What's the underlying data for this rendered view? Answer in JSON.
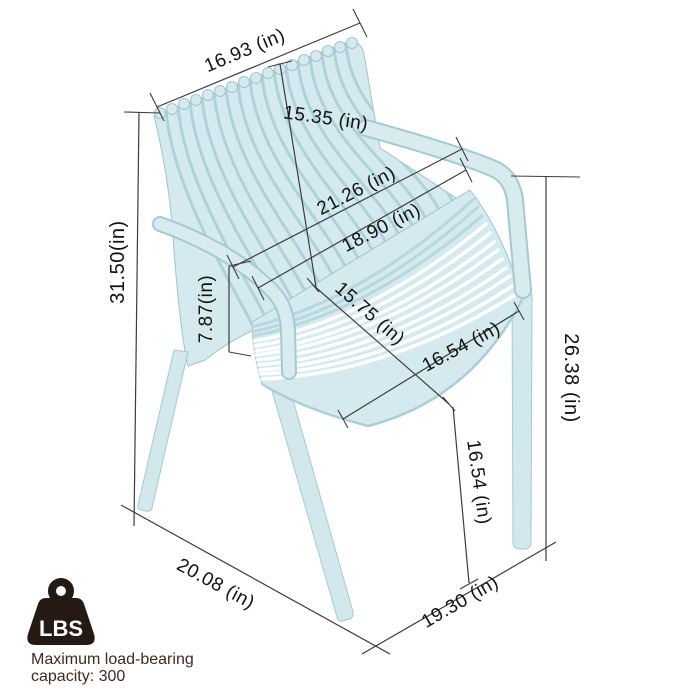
{
  "diagram": {
    "type": "product-dimension-diagram",
    "product": "slatted armchair",
    "unit": "in",
    "dimension_labels": {
      "top_width": "16.93 (in)",
      "backrest_height": "15.35 (in)",
      "armrest_outer_width": "21.26 (in)",
      "armrest_inner_width": "18.90 (in)",
      "overall_height": "31.50(in)",
      "seat_side_height": "7.87(in)",
      "seat_depth": "15.75 (in)",
      "seat_width": "16.54 (in)",
      "armrest_floor_height": "26.38 (in)",
      "seat_front_floor_height": "16.54 (in)",
      "base_depth": "20.08 (in)",
      "base_width": "19.30 (in)"
    },
    "load_info": {
      "icon_text": "LBS",
      "line1": "Maximum load-bearing",
      "line2": "capacity: 300"
    },
    "colors": {
      "chair": "#d5eaee",
      "chair_outline": "#9fc4cf",
      "backrest_gap": "#aed2da",
      "dimension_line": "#3c3c3c",
      "label_text": "#121212",
      "load_text": "#3d2a21",
      "icon": "#241a13"
    }
  }
}
